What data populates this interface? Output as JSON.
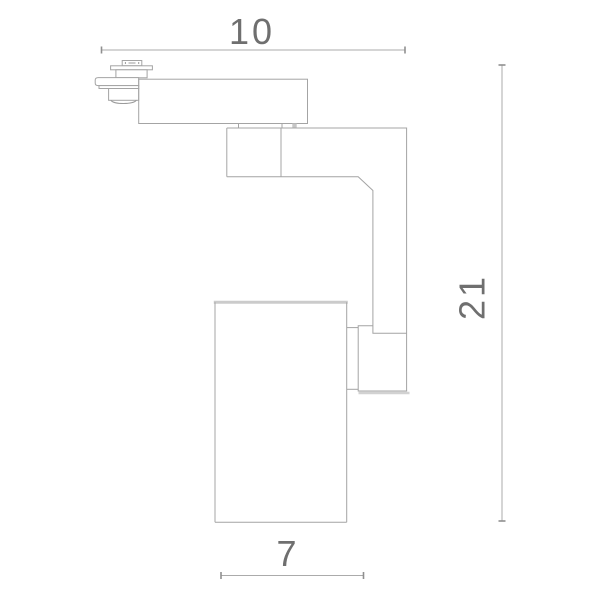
{
  "drawing": {
    "dimensions": {
      "top_width": "10",
      "right_height": "21",
      "bottom_width": "7"
    },
    "colors": {
      "outline": "#a4a4a4",
      "dimension_line": "#ababab",
      "thick_edge": "#cbcbcb",
      "label_text": "#6f6f6f",
      "background": "#ffffff"
    }
  }
}
